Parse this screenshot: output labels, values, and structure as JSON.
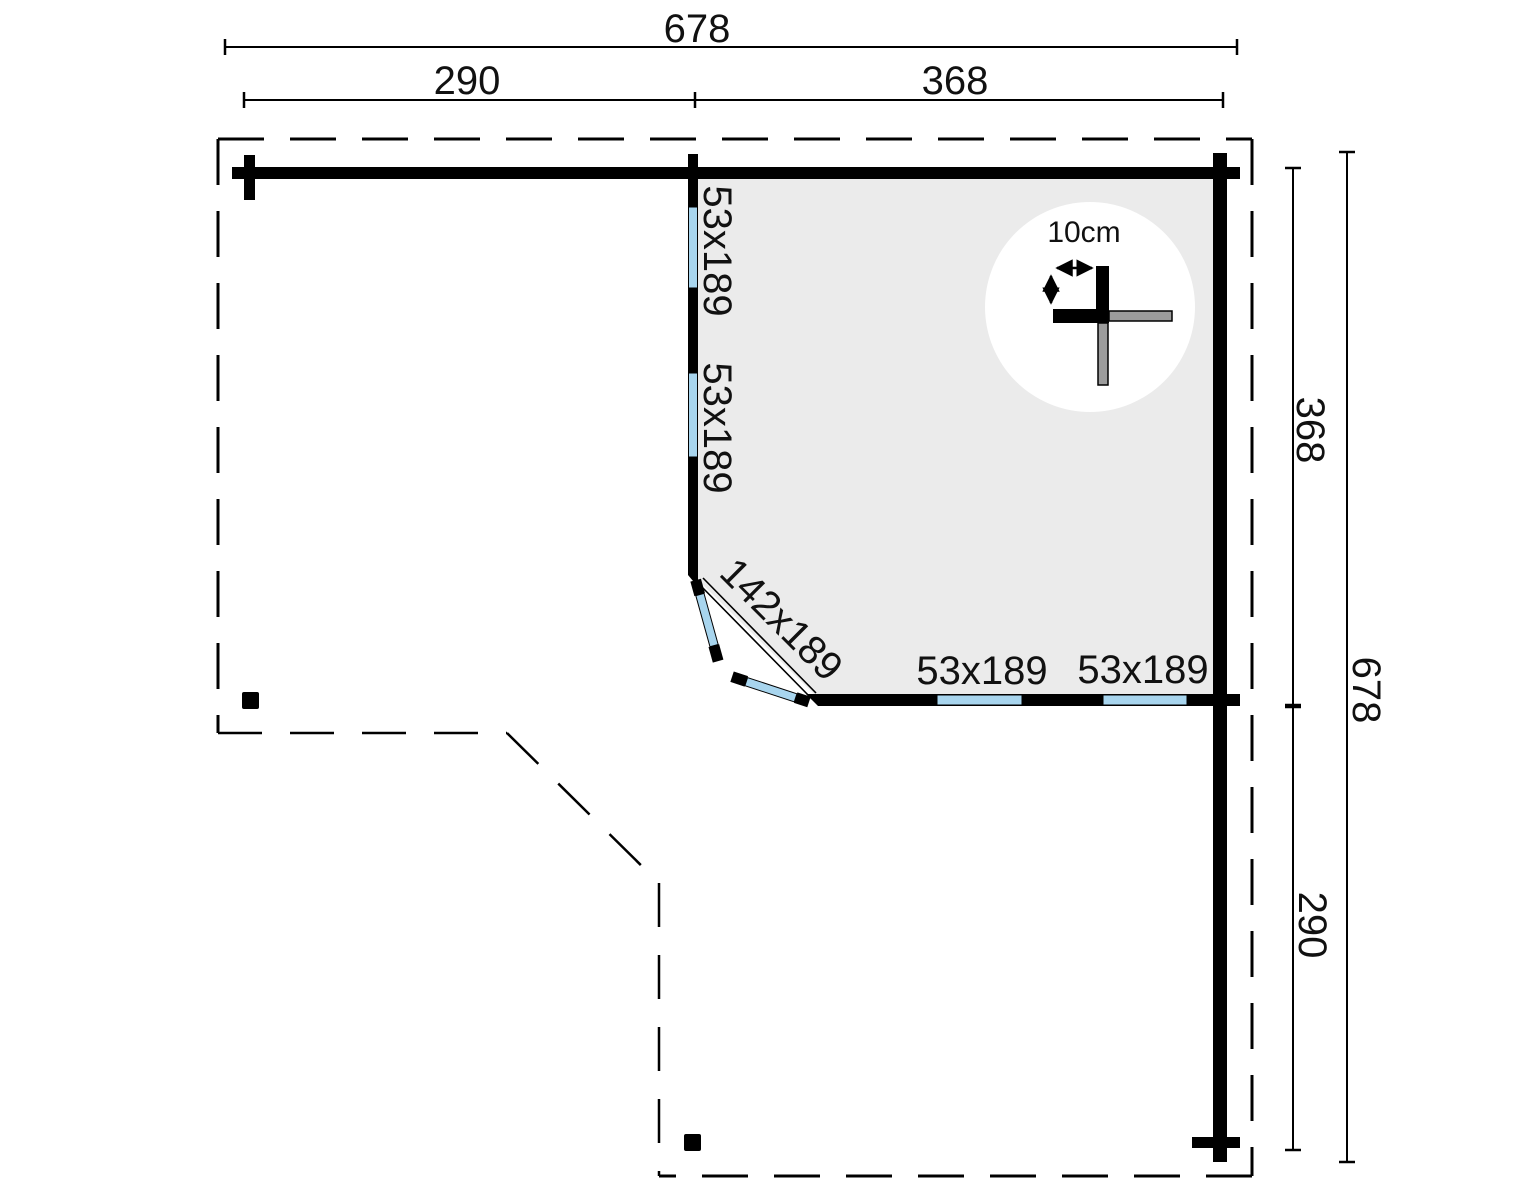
{
  "plan": {
    "top_dimensions": {
      "overall": "678",
      "left_section": "290",
      "right_section": "368"
    },
    "right_dimensions": {
      "upper_section": "368",
      "overall": "678",
      "lower_section": "290"
    },
    "window_labels": {
      "left_wall_upper": "53x189",
      "left_wall_lower": "53x189",
      "bottom_wall_left": "53x189",
      "bottom_wall_right": "53x189"
    },
    "door_label": "142x189",
    "corner_detail": {
      "label": "10cm"
    },
    "colors": {
      "window_blue": "#a8d5ee",
      "floor_gray": "#ebebeb",
      "log_gray": "#9c9c9c",
      "ink": "#000000"
    }
  }
}
